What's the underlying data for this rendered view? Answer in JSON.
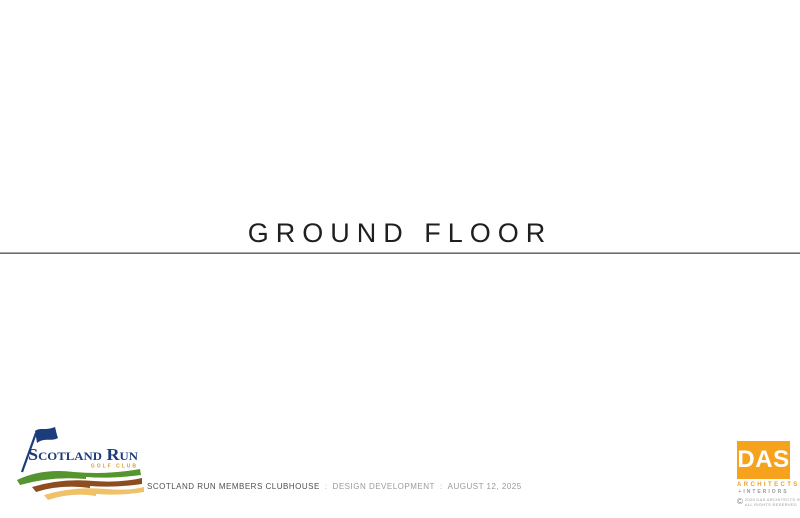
{
  "page": {
    "title": "GROUND FLOOR"
  },
  "footer": {
    "project": "SCOTLAND RUN MEMBERS CLUBHOUSE",
    "separator": ":",
    "phase": "DESIGN DEVELOPMENT",
    "date": "AUGUST 12, 2025"
  },
  "logos": {
    "scotland_run": {
      "name": "Scotland Run",
      "subtitle": "GOLF CLUB",
      "colors": {
        "navy": "#1d3c7c",
        "gold": "#d89a2e",
        "green": "#55952f",
        "brown": "#8d4d1e",
        "tan": "#f0c168"
      }
    },
    "das": {
      "initials": "DAS",
      "line1": "ARCHITECTS",
      "line2": "+INTERIORS",
      "copyright_symbol": "©",
      "copyright_line1": "2025 DAS ARCHITECTS INC.",
      "copyright_line2": "ALL RIGHTS RESERVED",
      "colors": {
        "orange": "#f6a21d",
        "gray": "#9a9a9a"
      }
    }
  }
}
